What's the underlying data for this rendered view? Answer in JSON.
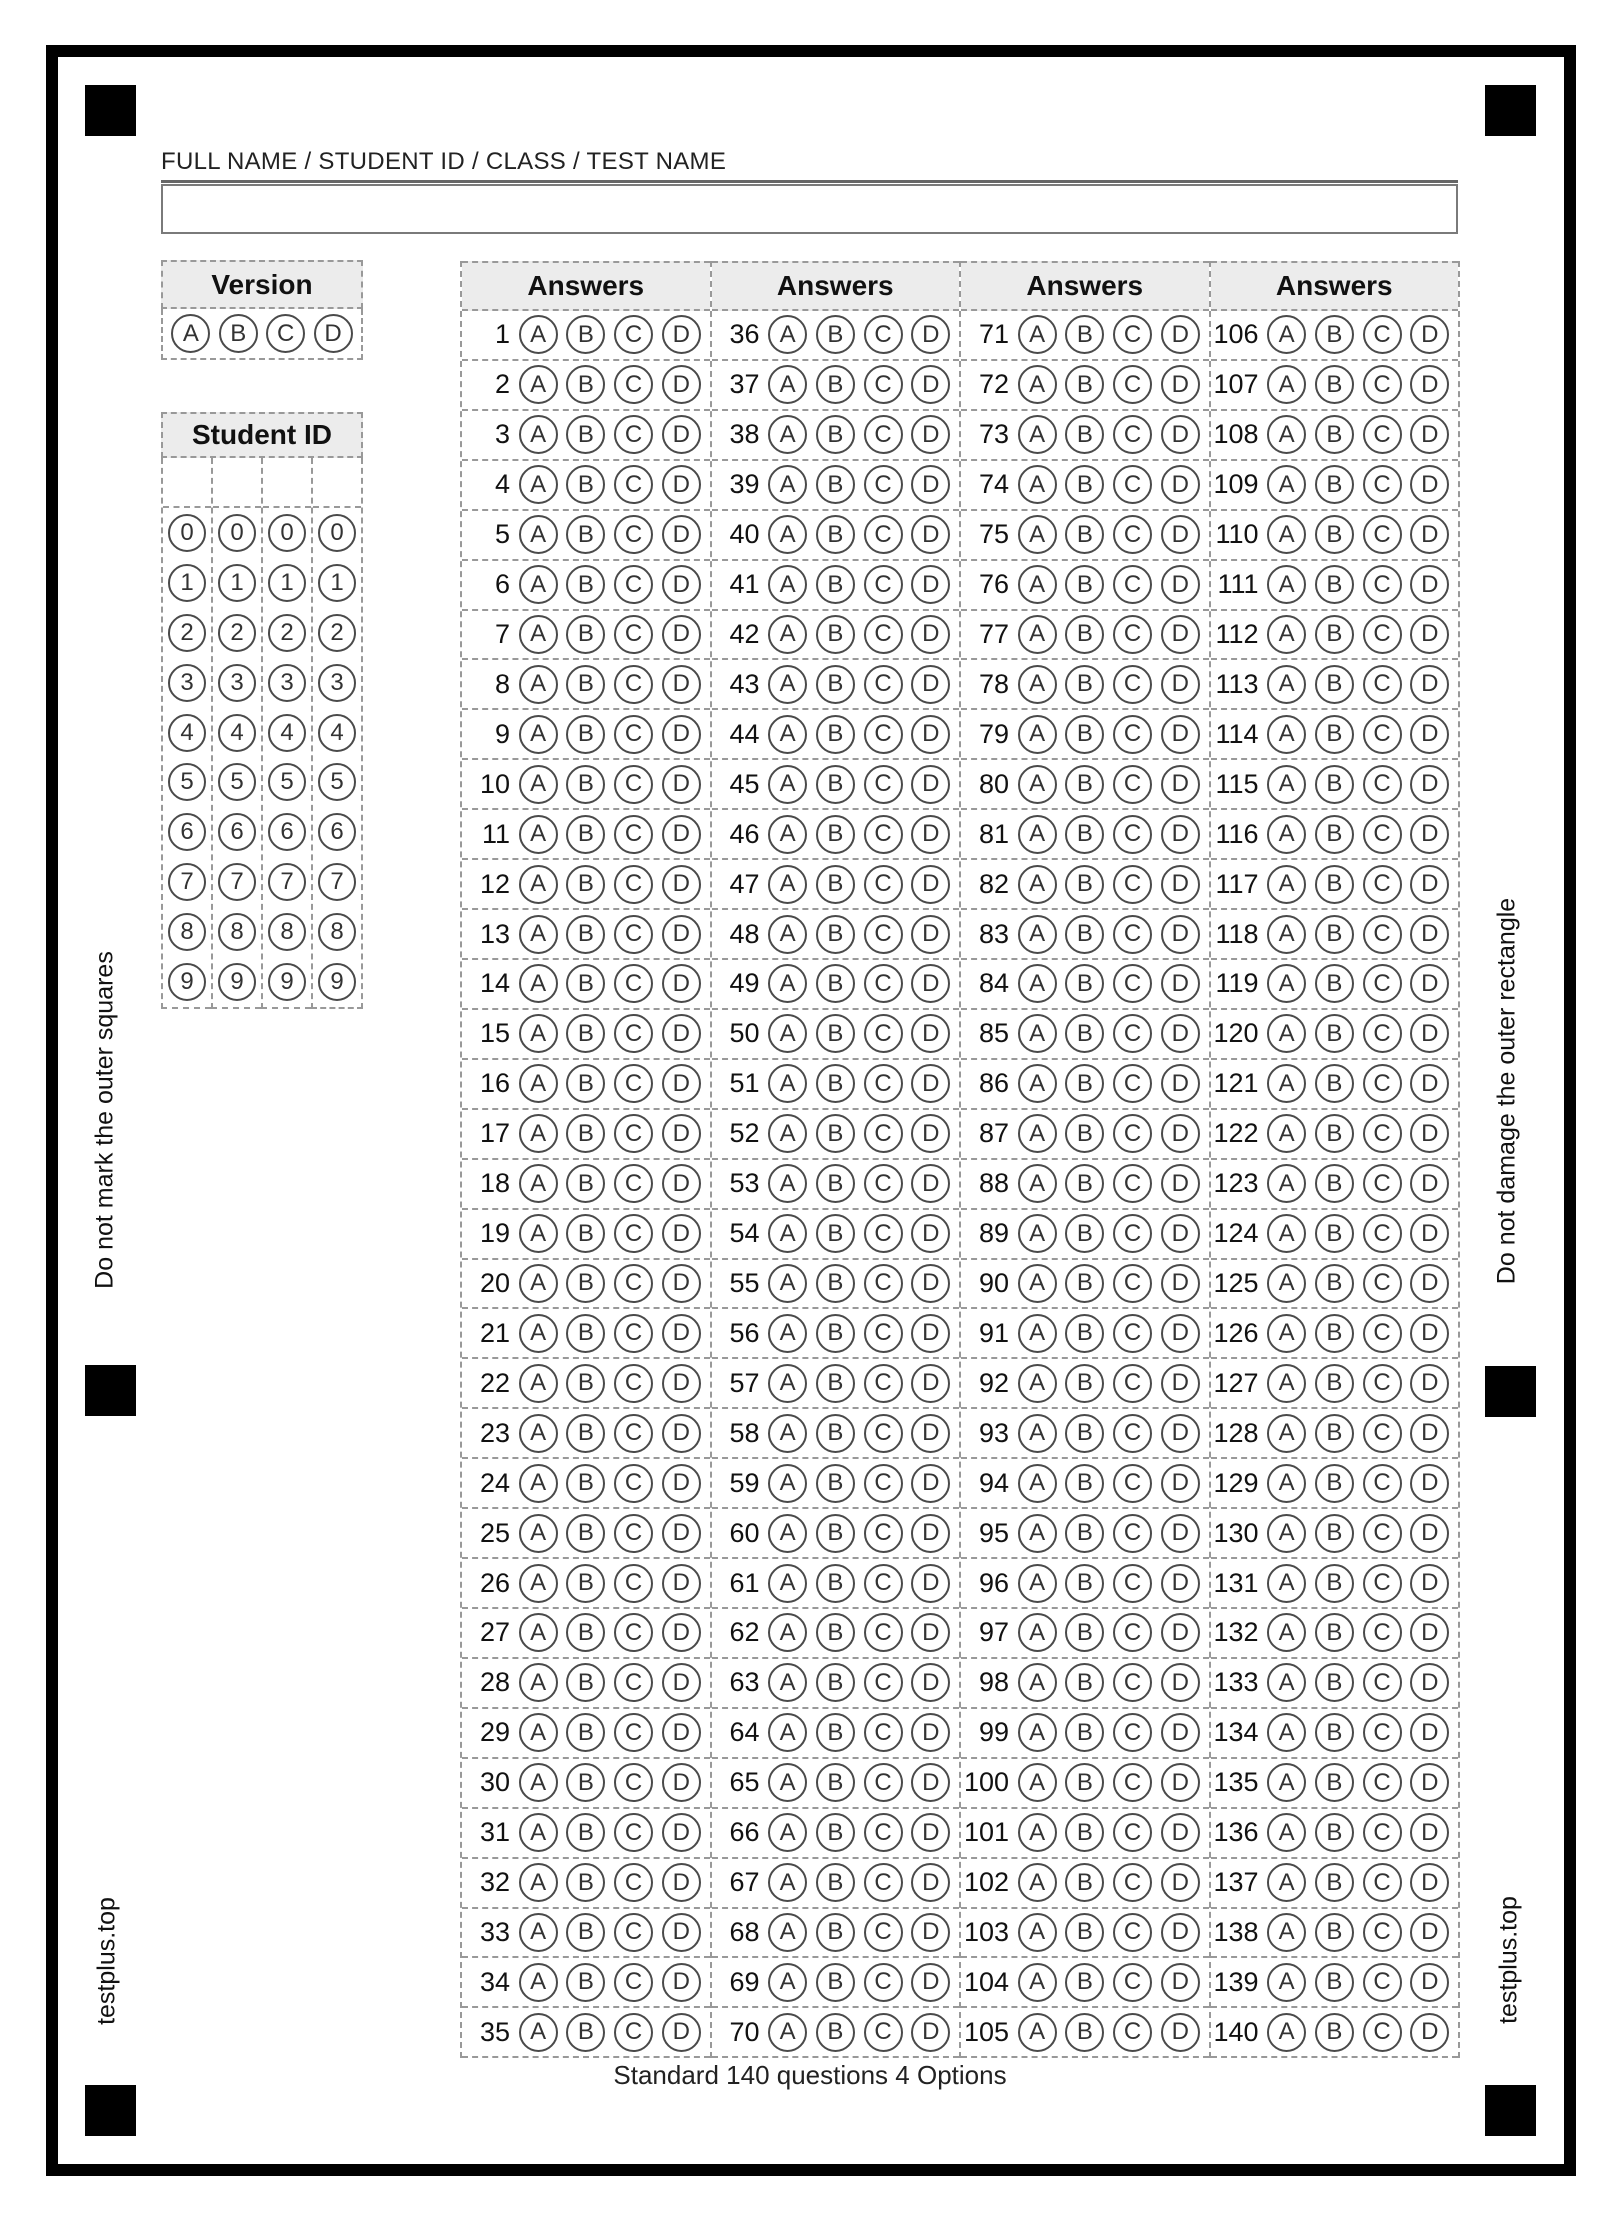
{
  "name_field": {
    "label": "FULL NAME / STUDENT ID / CLASS / TEST NAME",
    "value": "",
    "placeholder": ""
  },
  "version": {
    "title": "Version",
    "options": [
      "A",
      "B",
      "C",
      "D"
    ]
  },
  "student_id": {
    "title": "Student ID",
    "column_count": 4,
    "digits": [
      "0",
      "1",
      "2",
      "3",
      "4",
      "5",
      "6",
      "7",
      "8",
      "9"
    ]
  },
  "answers": {
    "header": "Answers",
    "options": [
      "A",
      "B",
      "C",
      "D"
    ],
    "columns": [
      {
        "questions": [
          1,
          2,
          3,
          4,
          5,
          6,
          7,
          8,
          9,
          10,
          11,
          12,
          13,
          14,
          15,
          16,
          17,
          18,
          19,
          20,
          21,
          22,
          23,
          24,
          25,
          26,
          27,
          28,
          29,
          30,
          31,
          32,
          33,
          34,
          35
        ]
      },
      {
        "questions": [
          36,
          37,
          38,
          39,
          40,
          41,
          42,
          43,
          44,
          45,
          46,
          47,
          48,
          49,
          50,
          51,
          52,
          53,
          54,
          55,
          56,
          57,
          58,
          59,
          60,
          61,
          62,
          63,
          64,
          65,
          66,
          67,
          68,
          69,
          70
        ]
      },
      {
        "questions": [
          71,
          72,
          73,
          74,
          75,
          76,
          77,
          78,
          79,
          80,
          81,
          82,
          83,
          84,
          85,
          86,
          87,
          88,
          89,
          90,
          91,
          92,
          93,
          94,
          95,
          96,
          97,
          98,
          99,
          100,
          101,
          102,
          103,
          104,
          105
        ]
      },
      {
        "questions": [
          106,
          107,
          108,
          109,
          110,
          111,
          112,
          113,
          114,
          115,
          116,
          117,
          118,
          119,
          120,
          121,
          122,
          123,
          124,
          125,
          126,
          127,
          128,
          129,
          130,
          131,
          132,
          133,
          134,
          135,
          136,
          137,
          138,
          139,
          140
        ]
      }
    ]
  },
  "side_notes": {
    "left_top": "Do not mark the outer squares",
    "left_bottom": "testplus.top",
    "right_top": "Do not damage the outer rectangle",
    "right_bottom": "testplus.top"
  },
  "footer": "Standard 140 questions 4 Options",
  "style": {
    "frame_color": "#000000",
    "dashed_border_color": "#999999",
    "header_background": "#ececec",
    "bubble_stroke": "#4a4a4a"
  }
}
